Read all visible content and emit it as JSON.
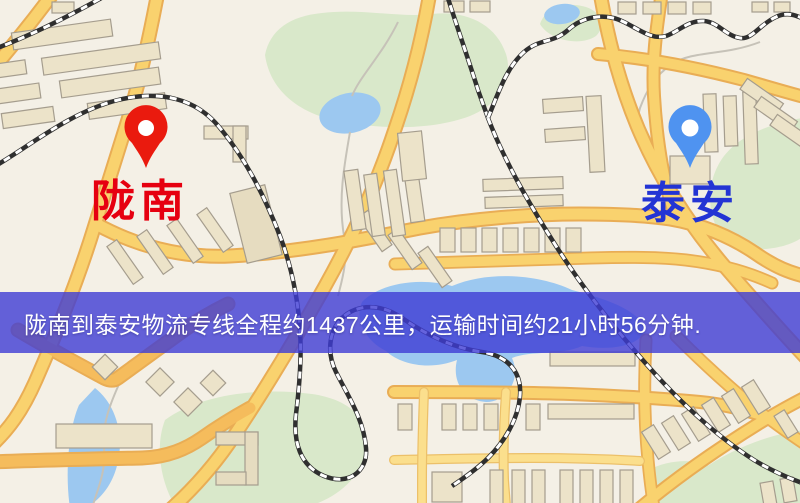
{
  "banner": {
    "text": "陇南到泰安物流专线全程约1437公里，运输时间约21小时56分钟.",
    "background_color": "#3e3cd4",
    "text_color": "#ffffff"
  },
  "origin": {
    "name": "陇南",
    "label_color": "#e60010",
    "pin_color": "#ea1a0e"
  },
  "destination": {
    "name": "泰安",
    "label_color": "#2334d4",
    "pin_color": "#4f93f0"
  },
  "map_colors": {
    "background": "#f4f0e6",
    "road_fill": "#f9d26e",
    "road_edge": "#e9ad55",
    "building_fill": "#ece3c9",
    "building_edge": "#a59d8e",
    "park_green": "#d9e8ca",
    "water_blue": "#9cc8f0",
    "railway_dark": "#2f2f2f"
  }
}
